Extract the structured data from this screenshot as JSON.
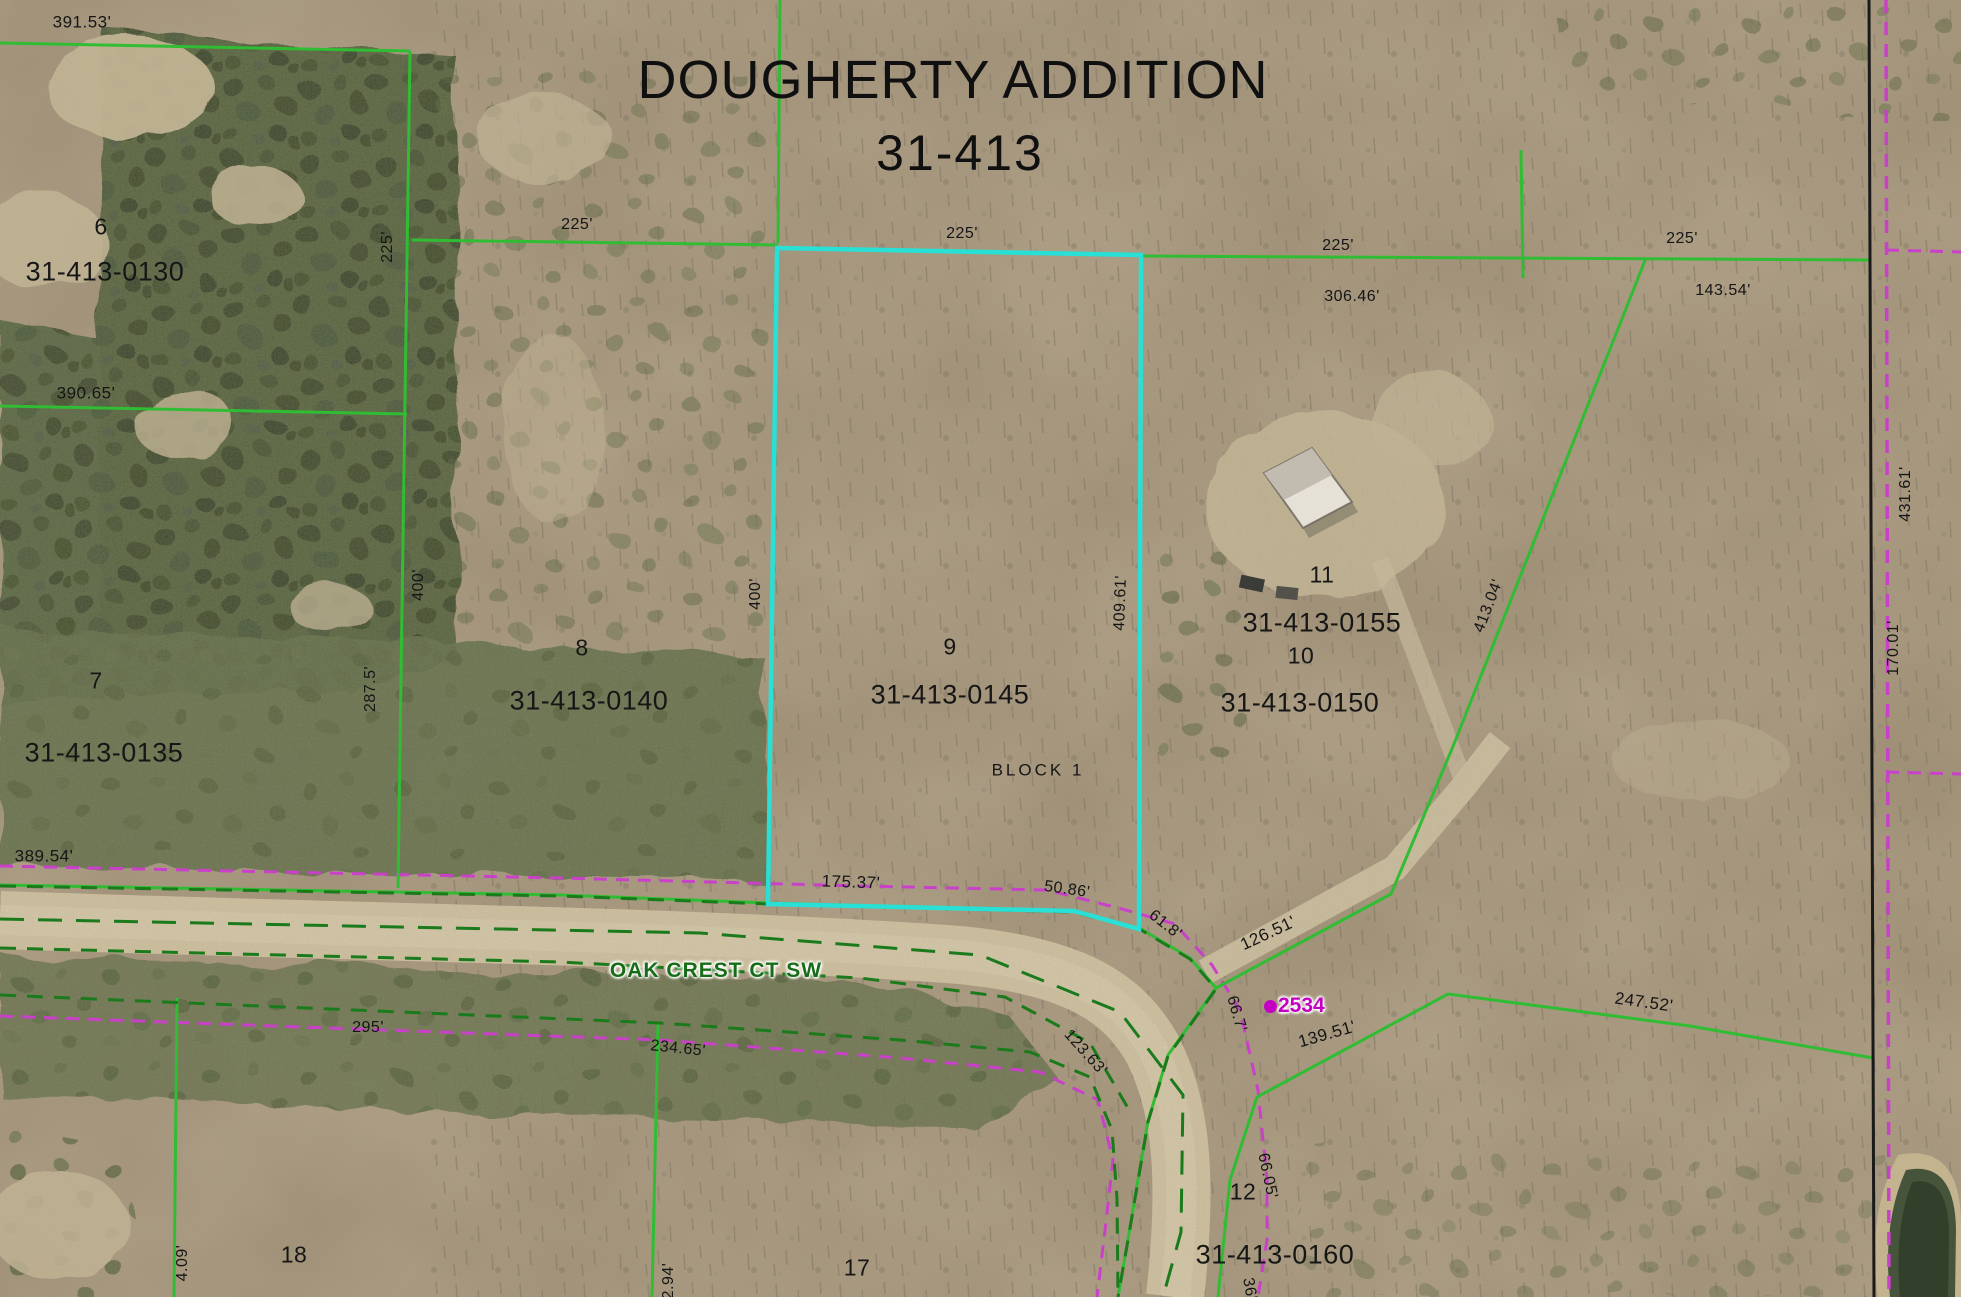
{
  "map": {
    "title_line1": "DOUGHERTY ADDITION",
    "title_line2": "31-413",
    "road_name": "OAK CREST CT SW",
    "address_marker": {
      "number": "2534"
    },
    "block_label": "BLOCK 1",
    "colors": {
      "boundary_green": "#30bd33",
      "road_edge_dashed_green": "#1b7a1b",
      "right_of_way_magenta": "#c941c9",
      "highlight_cyan": "#29e0d6",
      "section_line_black": "#1a1a1a",
      "label_text": "#161616",
      "road_name_green": "#176d17",
      "address_magenta": "#c400c4"
    },
    "parcel_ids": [
      "31-413-0130",
      "31-413-0135",
      "31-413-0140",
      "31-413-0145",
      "31-413-0150",
      "31-413-0155",
      "31-413-0160"
    ],
    "lot_numbers": [
      "6",
      "7",
      "8",
      "9",
      "10",
      "11",
      "12",
      "17",
      "18"
    ],
    "labels": [
      {
        "id": "dim-391-53",
        "text": "391.53'",
        "x": 82,
        "y": 22,
        "size": 17
      },
      {
        "id": "dim-390-65",
        "text": "390.65'",
        "x": 86,
        "y": 393,
        "size": 17
      },
      {
        "id": "dim-389-54",
        "text": "389.54'",
        "x": 44,
        "y": 856,
        "size": 17
      },
      {
        "id": "dim-225-a",
        "text": "225'",
        "x": 388,
        "y": 247,
        "size": 16,
        "rot": -90
      },
      {
        "id": "dim-225-b",
        "text": "225'",
        "x": 577,
        "y": 225,
        "size": 16
      },
      {
        "id": "dim-225-c",
        "text": "225'",
        "x": 962,
        "y": 234,
        "size": 16
      },
      {
        "id": "dim-225-d",
        "text": "225'",
        "x": 1338,
        "y": 246,
        "size": 16
      },
      {
        "id": "dim-306-46",
        "text": "306.46'",
        "x": 1352,
        "y": 297,
        "size": 16
      },
      {
        "id": "dim-225-e",
        "text": "225'",
        "x": 1682,
        "y": 239,
        "size": 16
      },
      {
        "id": "dim-143-54",
        "text": "143.54'",
        "x": 1723,
        "y": 291,
        "size": 16
      },
      {
        "id": "dim-400-a",
        "text": "400'",
        "x": 419,
        "y": 585,
        "size": 16,
        "rot": -90
      },
      {
        "id": "dim-287-5",
        "text": "287.5'",
        "x": 371,
        "y": 689,
        "size": 16,
        "rot": -90
      },
      {
        "id": "dim-400-b",
        "text": "400'",
        "x": 756,
        "y": 594,
        "size": 16,
        "rot": -90
      },
      {
        "id": "dim-409-61",
        "text": "409.61'",
        "x": 1121,
        "y": 603,
        "size": 16,
        "rot": -88
      },
      {
        "id": "dim-413-04",
        "text": "413.04'",
        "x": 1489,
        "y": 606,
        "size": 16,
        "rot": -69
      },
      {
        "id": "dim-431-61",
        "text": "431.61'",
        "x": 1906,
        "y": 494,
        "size": 16,
        "rot": -90
      },
      {
        "id": "dim-170-01",
        "text": "170.01'",
        "x": 1894,
        "y": 648,
        "size": 16,
        "rot": -90
      },
      {
        "id": "dim-175-37",
        "text": "175.37'",
        "x": 851,
        "y": 882,
        "size": 17,
        "rot": 2
      },
      {
        "id": "dim-50-86",
        "text": "50.86'",
        "x": 1067,
        "y": 890,
        "size": 16,
        "rot": 8
      },
      {
        "id": "dim-61-8",
        "text": "61.8'",
        "x": 1165,
        "y": 925,
        "size": 16,
        "rot": 38
      },
      {
        "id": "dim-126-51",
        "text": "126.51'",
        "x": 1268,
        "y": 933,
        "size": 17,
        "rot": -25
      },
      {
        "id": "dim-66-7",
        "text": "66.7'",
        "x": 1236,
        "y": 1014,
        "size": 16,
        "rot": 74
      },
      {
        "id": "dim-139-51",
        "text": "139.51'",
        "x": 1327,
        "y": 1034,
        "size": 17,
        "rot": -16
      },
      {
        "id": "dim-247-52",
        "text": "247.52'",
        "x": 1644,
        "y": 1002,
        "size": 17,
        "rot": 8
      },
      {
        "id": "dim-295",
        "text": "295'",
        "x": 368,
        "y": 1028,
        "size": 16
      },
      {
        "id": "dim-234-65",
        "text": "234.65'",
        "x": 678,
        "y": 1049,
        "size": 16,
        "rot": 6
      },
      {
        "id": "dim-123-63",
        "text": "123.63'",
        "x": 1085,
        "y": 1053,
        "size": 16,
        "rot": 48
      },
      {
        "id": "dim-66-05",
        "text": "66.05'",
        "x": 1267,
        "y": 1176,
        "size": 16,
        "rot": 78
      },
      {
        "id": "dim-36",
        "text": "36'",
        "x": 1249,
        "y": 1289,
        "size": 16,
        "rot": 80
      },
      {
        "id": "dim-4-09",
        "text": "4.09'",
        "x": 183,
        "y": 1263,
        "size": 16,
        "rot": -90
      },
      {
        "id": "dim-2-94",
        "text": "2.94'",
        "x": 669,
        "y": 1281,
        "size": 16,
        "rot": -90
      },
      {
        "id": "lot-6",
        "text": "6",
        "x": 101,
        "y": 227,
        "size": 23
      },
      {
        "id": "lot-7",
        "text": "7",
        "x": 96,
        "y": 681,
        "size": 23
      },
      {
        "id": "lot-8",
        "text": "8",
        "x": 582,
        "y": 648,
        "size": 23
      },
      {
        "id": "lot-9",
        "text": "9",
        "x": 950,
        "y": 647,
        "size": 23
      },
      {
        "id": "lot-10",
        "text": "10",
        "x": 1301,
        "y": 656,
        "size": 23
      },
      {
        "id": "lot-11",
        "text": "11",
        "x": 1322,
        "y": 575,
        "size": 23
      },
      {
        "id": "lot-12",
        "text": "12",
        "x": 1243,
        "y": 1192,
        "size": 23
      },
      {
        "id": "lot-17",
        "text": "17",
        "x": 857,
        "y": 1268,
        "size": 23
      },
      {
        "id": "lot-18",
        "text": "18",
        "x": 294,
        "y": 1255,
        "size": 23
      },
      {
        "id": "parcel-31-413-0130",
        "text": "31-413-0130",
        "x": 105,
        "y": 272,
        "size": 27
      },
      {
        "id": "parcel-31-413-0135",
        "text": "31-413-0135",
        "x": 104,
        "y": 753,
        "size": 27
      },
      {
        "id": "parcel-31-413-0140",
        "text": "31-413-0140",
        "x": 589,
        "y": 701,
        "size": 27
      },
      {
        "id": "parcel-31-413-0145",
        "text": "31-413-0145",
        "x": 950,
        "y": 695,
        "size": 27
      },
      {
        "id": "parcel-31-413-0150",
        "text": "31-413-0150",
        "x": 1300,
        "y": 703,
        "size": 27
      },
      {
        "id": "parcel-31-413-0155",
        "text": "31-413-0155",
        "x": 1322,
        "y": 623,
        "size": 27
      },
      {
        "id": "parcel-31-413-0160",
        "text": "31-413-0160",
        "x": 1275,
        "y": 1255,
        "size": 27
      },
      {
        "id": "block-label",
        "text": "BLOCK 1",
        "x": 1038,
        "y": 770,
        "size": 17,
        "cls": "spaced"
      }
    ]
  }
}
